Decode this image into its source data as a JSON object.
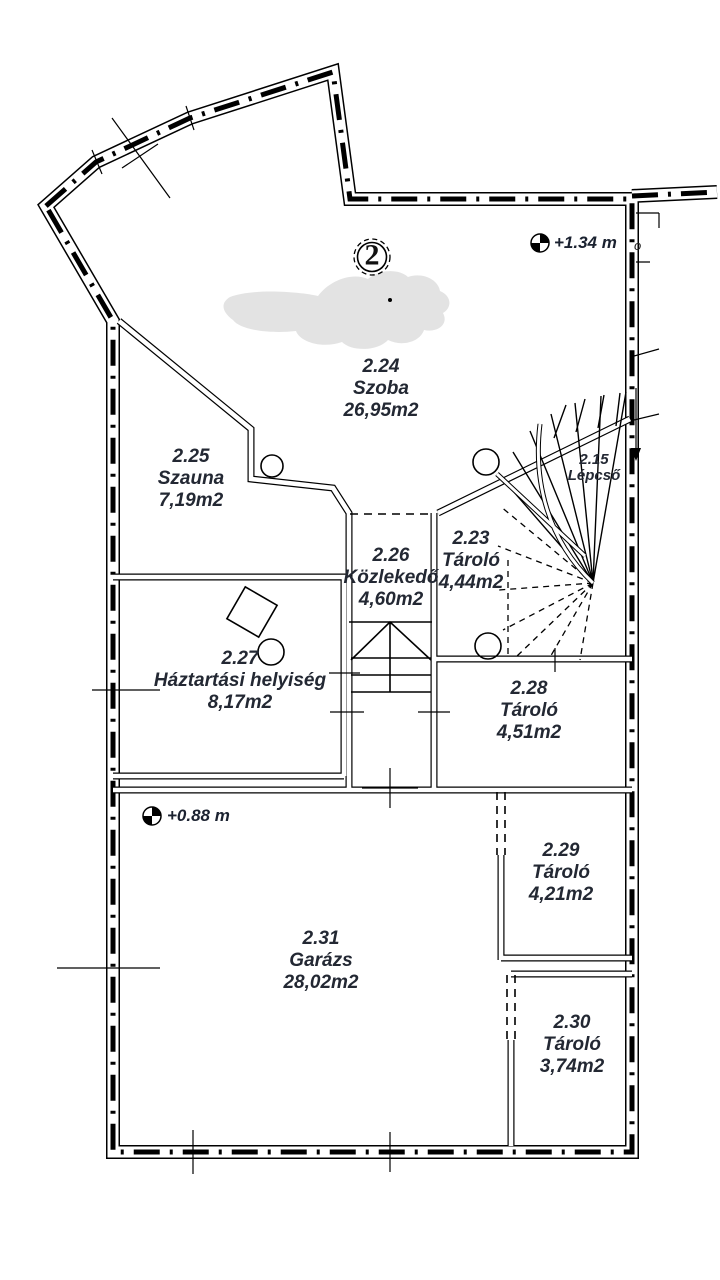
{
  "plan": {
    "badge": "2",
    "levels": {
      "upper": "+1.34 m",
      "lower": "+0.88 m"
    },
    "edge_fragment": "o",
    "rooms": [
      {
        "id": "2.24",
        "name": "Szoba",
        "area": "26,95m2"
      },
      {
        "id": "2.25",
        "name": "Szauna",
        "area": "7,19m2"
      },
      {
        "id": "2.26",
        "name": "Közlekedő",
        "area": "4,60m2"
      },
      {
        "id": "2.23",
        "name": "Tároló",
        "area": "4,44m2"
      },
      {
        "id": "2.15",
        "name": "Lépcső",
        "area": ""
      },
      {
        "id": "2.27",
        "name": "Háztartási helyiség",
        "area": "8,17m2"
      },
      {
        "id": "2.28",
        "name": "Tároló",
        "area": "4,51m2"
      },
      {
        "id": "2.29",
        "name": "Tároló",
        "area": "4,21m2"
      },
      {
        "id": "2.30",
        "name": "Tároló",
        "area": "3,74m2"
      },
      {
        "id": "2.31",
        "name": "Garázs",
        "area": "28,02m2"
      }
    ],
    "colors": {
      "line": "#000000",
      "text": "#232833",
      "smudge": "#e3e3e3",
      "background": "#ffffff"
    }
  }
}
